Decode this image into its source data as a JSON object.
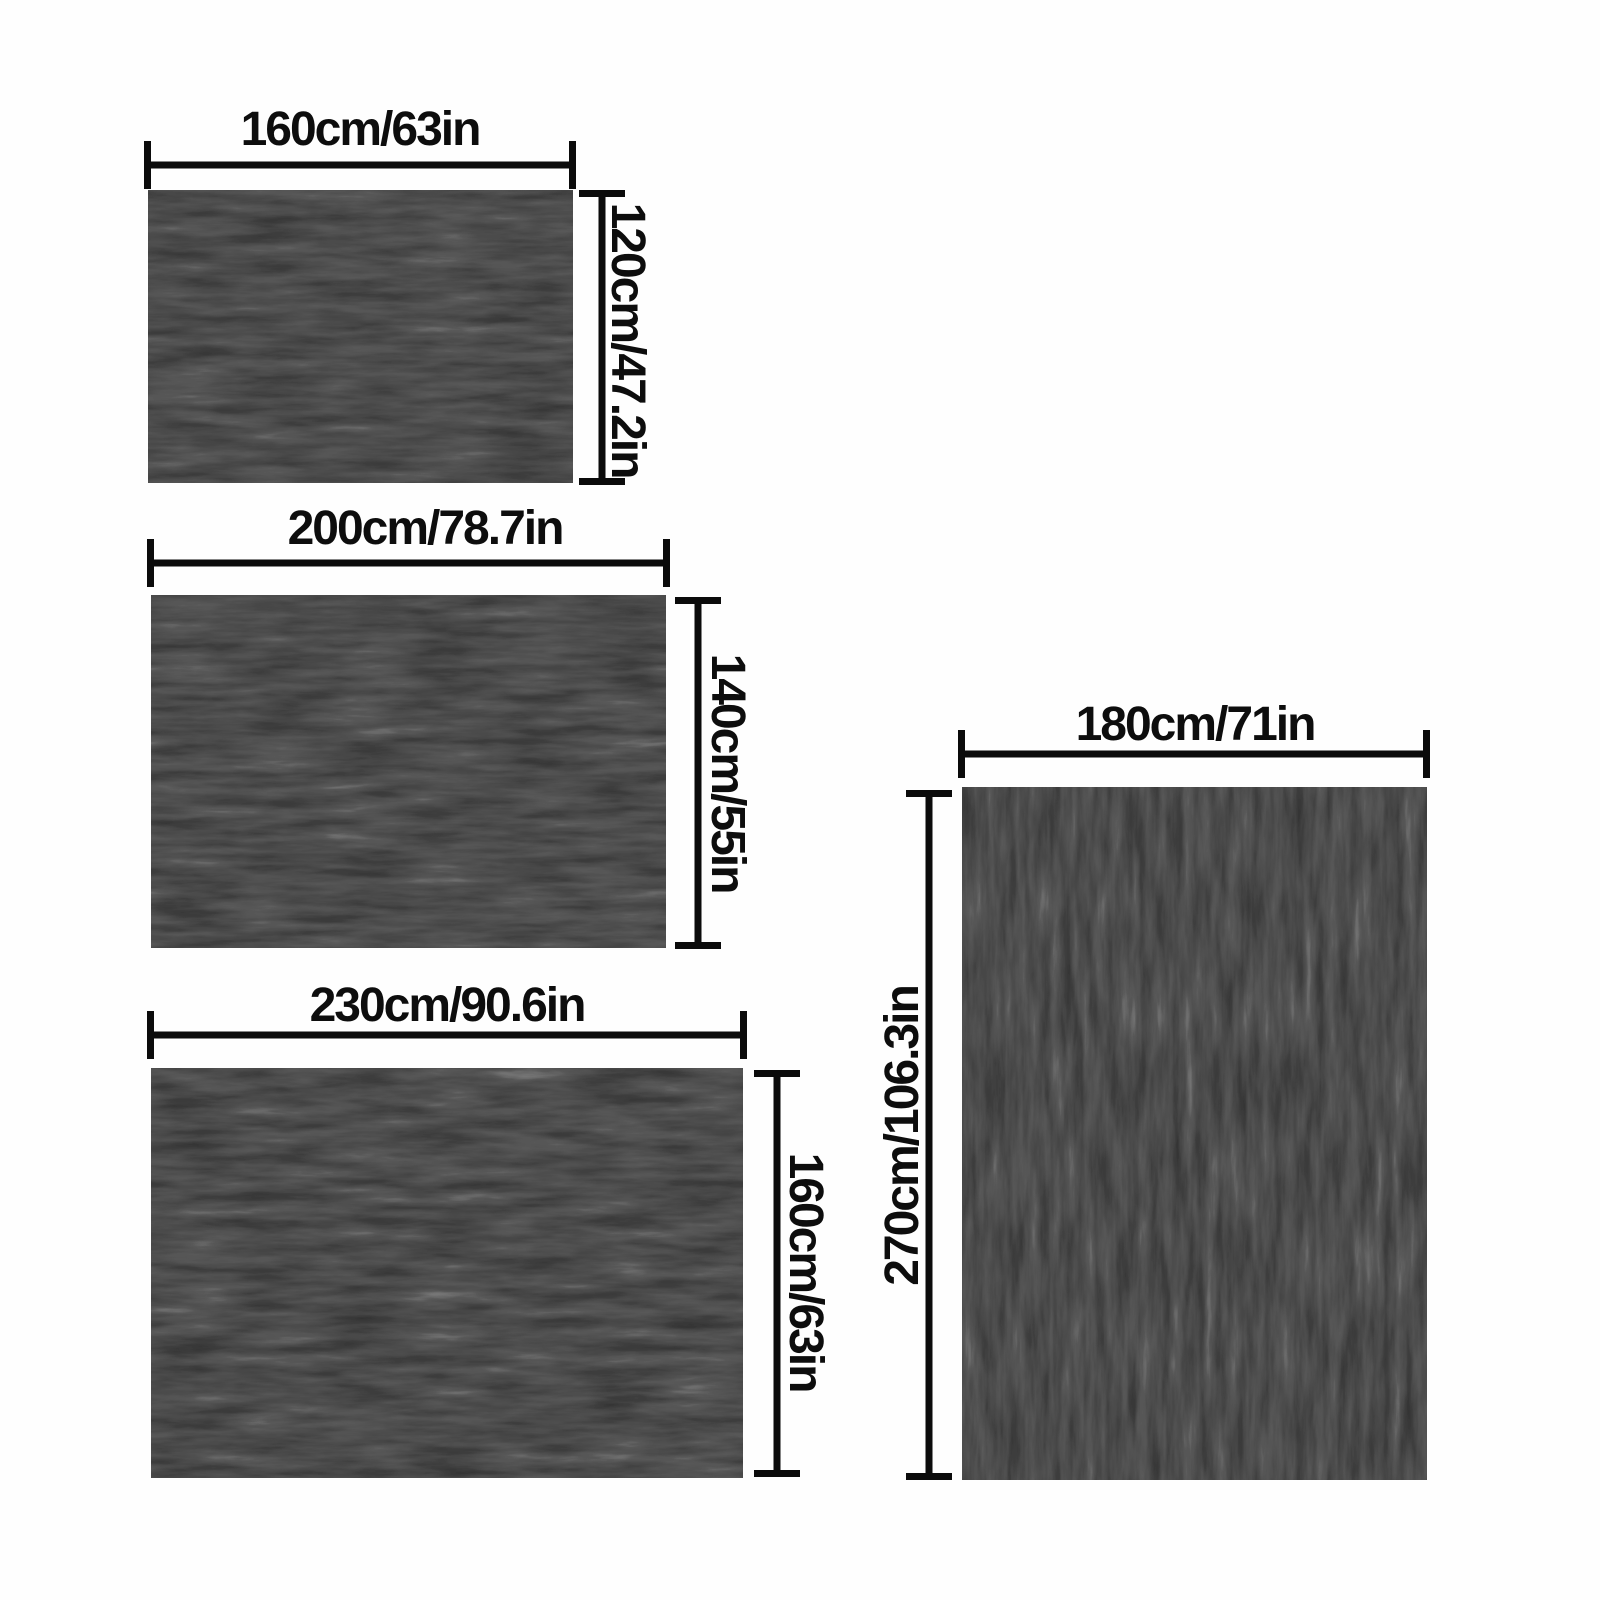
{
  "colors": {
    "background": "#fefefe",
    "line": "#0b0b0b",
    "text": "#0d0d0d",
    "rug-base": "#0c0c0c"
  },
  "sizes": [
    {
      "width_label": "160cm/63in",
      "height_label": "120cm/47.2in"
    },
    {
      "width_label": "200cm/78.7in",
      "height_label": "140cm/55in"
    },
    {
      "width_label": "230cm/90.6in",
      "height_label": "160cm/63in"
    },
    {
      "width_label": "180cm/71in",
      "height_label": "270cm/106.3in"
    }
  ]
}
